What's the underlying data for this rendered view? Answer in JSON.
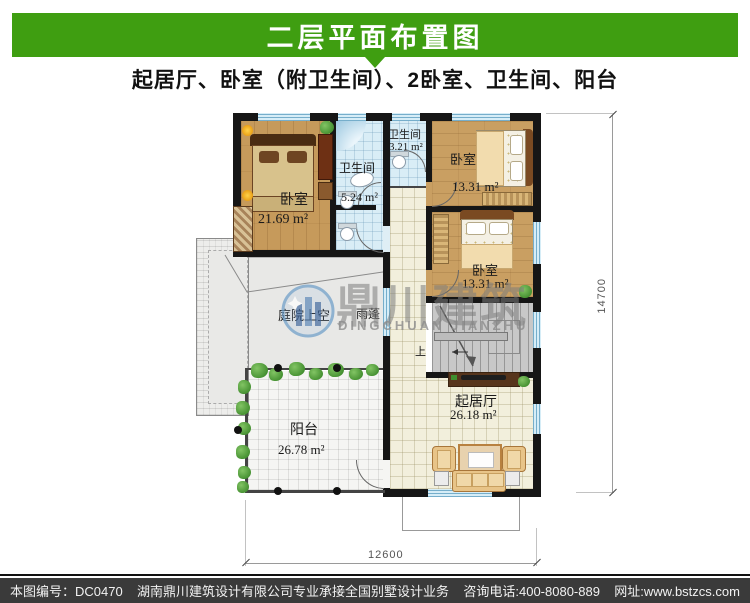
{
  "header": {
    "title": "二层平面布置图",
    "subtitle": "起居厅、卧室（附卫生间）、2卧室、卫生间、阳台"
  },
  "colors": {
    "banner_green": "#3f9e11",
    "footer_bar": "#3a3a3a",
    "bath_tile_blue": "#d9edf6",
    "wood_floor": "#c69a5b"
  },
  "rooms": {
    "bedroom1": {
      "label": "卧室",
      "area": "21.69 m²"
    },
    "bath1": {
      "label": "卫生间",
      "area": "5.24 m²"
    },
    "bath2": {
      "label": "卫生间",
      "area": "3.21 m²"
    },
    "bedroom2": {
      "label": "卧室",
      "area": "13.31 m²"
    },
    "bedroom3": {
      "label": "卧室",
      "area": "13.31 m²"
    },
    "living": {
      "label": "起居厅",
      "area": "26.18 m²"
    },
    "balcony": {
      "label": "阳台",
      "area": "26.78 m²"
    },
    "courtyard": {
      "label": "庭院上空"
    },
    "canopy": {
      "label": "雨蓬"
    },
    "stairs": {
      "label": "上"
    }
  },
  "dimensions": {
    "height_mm": "14700",
    "width_mm": "12600"
  },
  "watermark": {
    "cn": "鼎川建筑",
    "en": "DINGCHUAN JIANZHU"
  },
  "footer": {
    "serial": "本图编号：DC0470",
    "company": "湖南鼎川建筑设计有限公司专业承接全国别墅设计业务",
    "phone": "咨询电话:400-8080-889",
    "website": "网址:www.bstzcs.com"
  }
}
